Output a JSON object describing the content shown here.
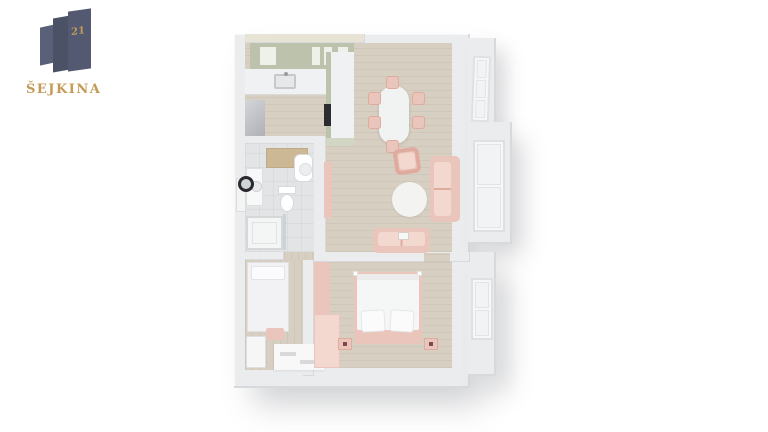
{
  "brand": {
    "number": "21",
    "name": "ŠEJKINA"
  },
  "colors": {
    "gold": "#c49a58",
    "slateA": "#5a6078",
    "slateB": "#4b5265",
    "slateC": "#525970",
    "wall": "#ebecee",
    "wallShade": "#d8d9dc",
    "wallDark": "#c9cacd",
    "cream": "#e7e4d6",
    "wood": "#d7d0c2",
    "woodDark": "#cdc2ae",
    "tile": "#e3e4e5",
    "sage": "#bcc2ab",
    "sageLight": "#d2d6c4",
    "marble": "#eff1f2",
    "pink": "#eac5bb",
    "pinkLight": "#f3d8d0",
    "pinkDark": "#dfab9f",
    "whiteSoft": "#f6f7f7",
    "metal": "#c3c5c9",
    "dark": "#2c2c30"
  },
  "scene": {
    "type": "3d-floor-plan-render",
    "rooms": [
      {
        "name": "kitchen",
        "items": [
          "upper-cabinets",
          "counter-with-sink",
          "peninsula-counter",
          "oven",
          "fridge"
        ]
      },
      {
        "name": "dining-area",
        "items": [
          "oval-table",
          "six-pink-chairs",
          "window-northeast"
        ]
      },
      {
        "name": "living-room",
        "items": [
          "armchair",
          "sofa-east",
          "round-rug",
          "sofa-south",
          "bay-window-east"
        ]
      },
      {
        "name": "bathroom",
        "items": [
          "wood-counter",
          "washing-machine",
          "vanity-with-round-mirror",
          "toilet",
          "shower"
        ]
      },
      {
        "name": "second-room-hall",
        "items": [
          "single-bed",
          "pink-stool",
          "white-dresser",
          "striped-rug"
        ]
      },
      {
        "name": "bedroom",
        "items": [
          "double-bed-pink-frame",
          "two-pillows",
          "two-nightstands",
          "pink-wardrobes",
          "window-east"
        ]
      }
    ]
  }
}
